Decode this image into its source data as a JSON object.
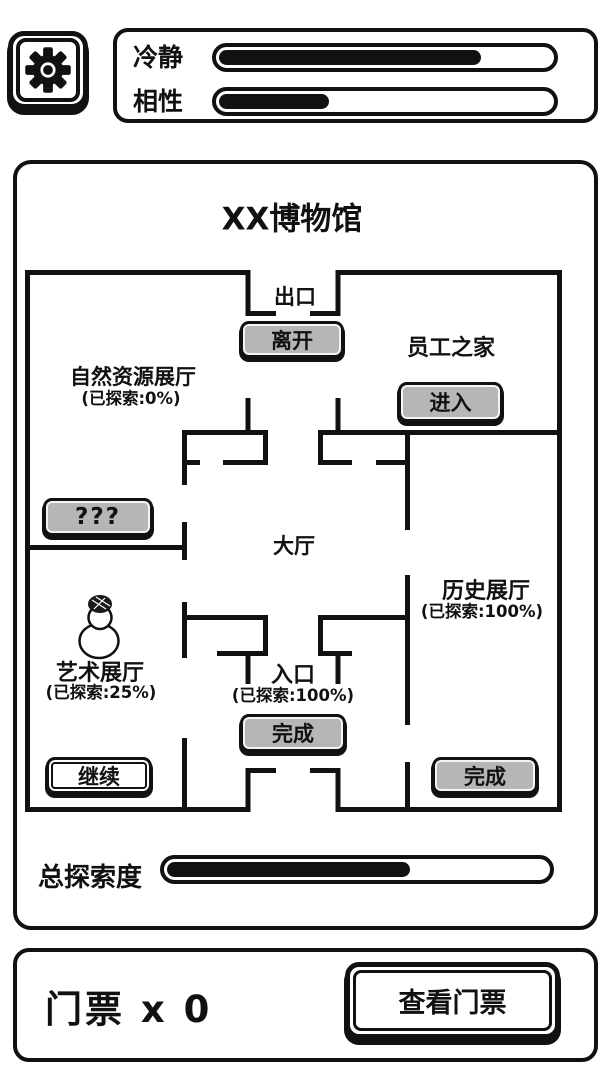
{
  "colors": {
    "ink": "#111111",
    "button_grey": "#b6b6b6",
    "background": "#ffffff"
  },
  "topbar": {
    "settings_button": {
      "icon": "gear-icon"
    },
    "stats": [
      {
        "label": "冷静",
        "percent": 79
      },
      {
        "label": "相性",
        "percent": 33
      }
    ]
  },
  "museum": {
    "title": "XX博物馆",
    "exit": {
      "label": "出口",
      "leave_button": "离开"
    },
    "staff_home": {
      "name": "员工之家",
      "enter_button": "进入"
    },
    "natural_resources_hall": {
      "name": "自然资源展厅",
      "explored": "(已探索:0%)"
    },
    "mystery_room": {
      "button": "???"
    },
    "main_hall": {
      "name": "大厅"
    },
    "history_hall": {
      "name": "历史展厅",
      "explored": "(已探索:100%)",
      "finish_button": "完成"
    },
    "art_hall": {
      "name": "艺术展厅",
      "explored": "(已探索:25%)",
      "continue_button": "继续"
    },
    "entrance": {
      "name": "入口",
      "explored": "(已探索:100%)",
      "finish_button": "完成"
    },
    "character": {
      "name": "snowman-player-marker"
    },
    "total_exploration": {
      "label": "总探索度",
      "percent": 64
    }
  },
  "footer": {
    "tickets_count": "门票 x 0",
    "view_tickets_button": "查看门票"
  }
}
